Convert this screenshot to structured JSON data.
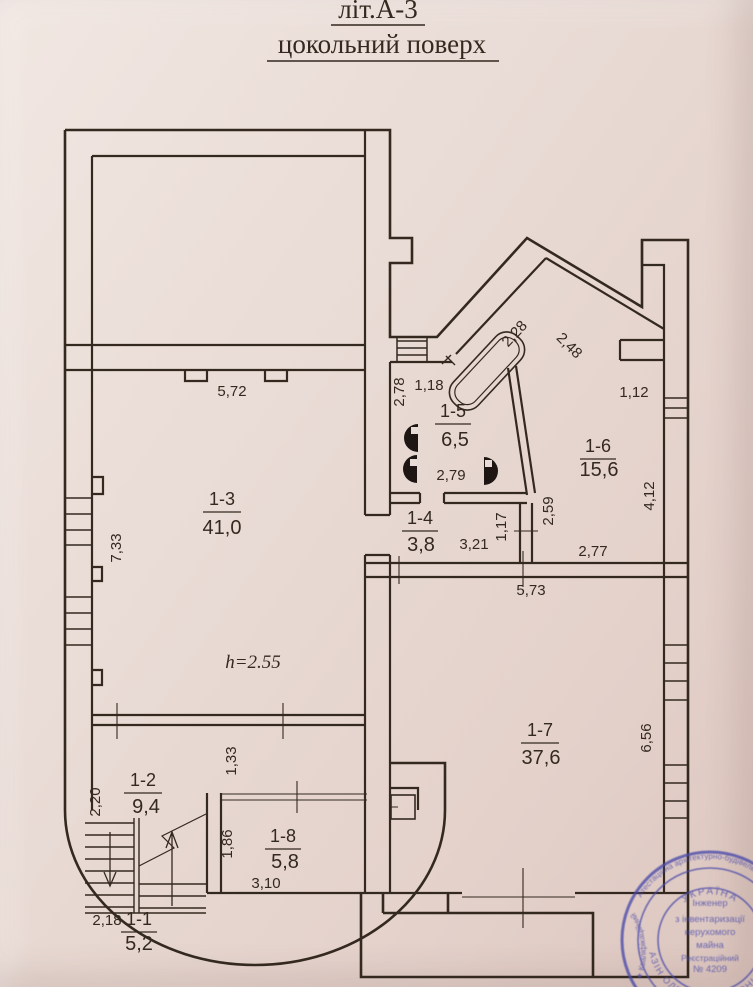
{
  "title": {
    "line1": "літ.А-3",
    "line2": "цокольний поверх"
  },
  "height_note": "h=2.55",
  "rooms": {
    "r11": {
      "id": "1-1",
      "area": "5,2"
    },
    "r12": {
      "id": "1-2",
      "area": "9,4"
    },
    "r13": {
      "id": "1-3",
      "area": "41,0"
    },
    "r14": {
      "id": "1-4",
      "area": "3,8"
    },
    "r15": {
      "id": "1-5",
      "area": "6,5"
    },
    "r16": {
      "id": "1-6",
      "area": "15,6"
    },
    "r17": {
      "id": "1-7",
      "area": "37,6"
    },
    "r18": {
      "id": "1-8",
      "area": "5,8"
    }
  },
  "dims": {
    "d572": "5,72",
    "d278": "2,78",
    "d118": "1,18",
    "d228": "2,28",
    "d248": "2,48",
    "d112": "1,12",
    "d733": "7,33",
    "d279": "2,79",
    "d117": "1,17",
    "d259": "2,59",
    "d321": "3,21",
    "d277": "2,77",
    "d412": "4,12",
    "d573": "5,73",
    "d656": "6,56",
    "d133": "1,33",
    "d220": "2,20",
    "d186": "1,86",
    "d310": "3,10",
    "d218": "2,18"
  },
  "stamp": {
    "country": "УКРАЇНА",
    "line1": "Інженер",
    "line2": "з інвентаризації",
    "line3": "нерухомого",
    "line4": "майна",
    "line5": "Реєстраційний",
    "line6": "№ 4209",
    "ring_name": "ЛАЗІН ОЛЕКСАНДР ЛЕОНІДОВИЧ",
    "ring_outer_top": "Атестаційна архітектурно-будівельна комісія",
    "ring_outer_left": "★ Кваліфікаційний"
  },
  "colors": {
    "paper": "#e9dbd5",
    "ink": "#33291f",
    "stamp": "#4a4aaa"
  }
}
